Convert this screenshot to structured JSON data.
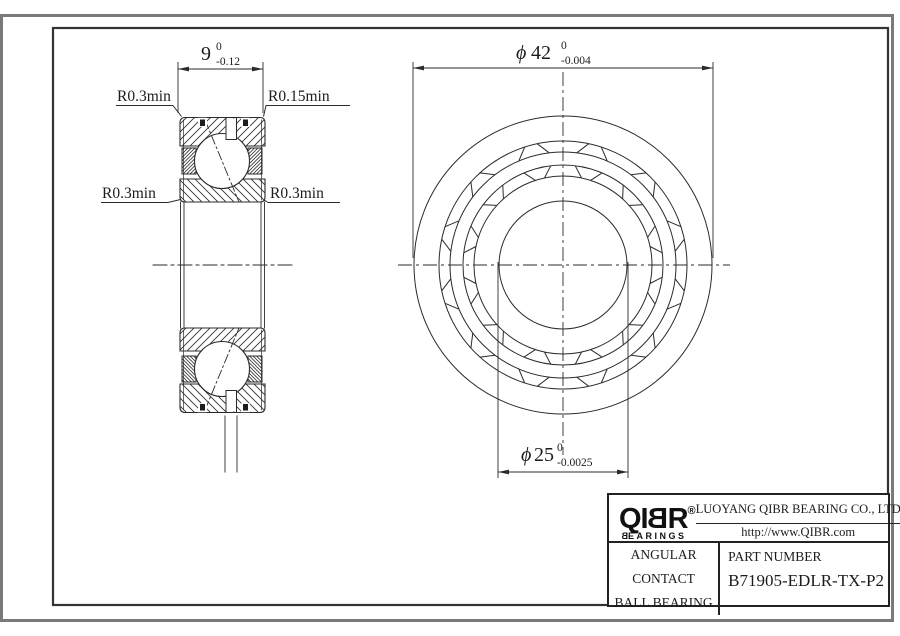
{
  "drawing": {
    "dim_width": {
      "value": "9",
      "tol_upper": "0",
      "tol_lower": "-0.12"
    },
    "dim_od": {
      "symbol": "ϕ",
      "value": "42",
      "tol_upper": "0",
      "tol_lower": "-0.004"
    },
    "dim_bore": {
      "symbol": "ϕ",
      "value": "25",
      "tol_upper": "0",
      "tol_lower": "-0.0025"
    },
    "radius_labels": {
      "top_left": "R0.3min",
      "top_right": "R0.15min",
      "mid_left": "R0.3min",
      "mid_right": "R0.3min"
    }
  },
  "title_block": {
    "logo": {
      "part1": "QI",
      "mirrored_letter": "B",
      "part2": "R",
      "registered": "®",
      "subtitle_first": "B",
      "subtitle_rest": "EARINGS"
    },
    "company": "LUOYANG QIBR BEARING CO., LTD",
    "website": "http://www.QIBR.com",
    "product_type_line1": "ANGULAR CONTACT",
    "product_type_line2": "BALL BEARING",
    "part_number_label": "PART NUMBER",
    "part_number": "B71905-EDLR-TX-P2"
  }
}
